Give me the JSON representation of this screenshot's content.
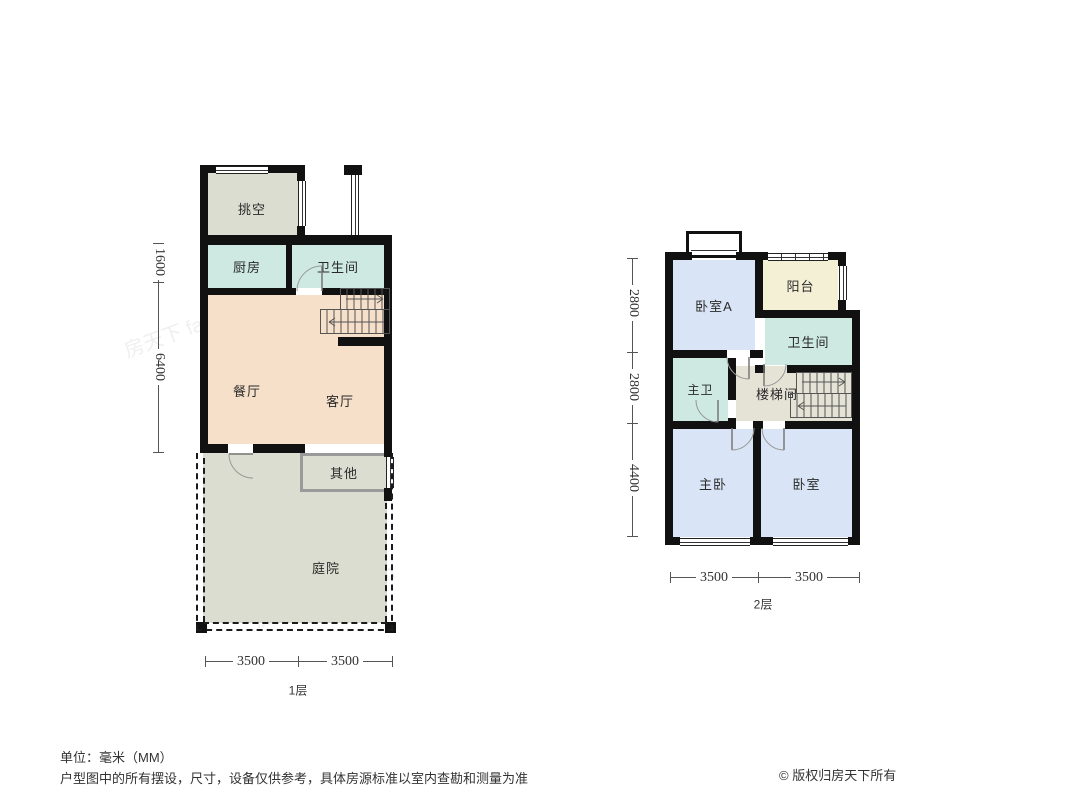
{
  "meta": {
    "unit_note": "单位：毫米（MM）",
    "disclaimer": "户型图中的所有摆设，尺寸，设备仅供参考，具体房源标准以室内查勘和测量为准",
    "copyright": "© 版权归房天下所有",
    "watermark": "房天下 fang.com"
  },
  "colors": {
    "wall": "#111111",
    "living": "#f6e0ca",
    "wet": "#cde9e2",
    "gray": "#dbddd1",
    "bedroom": "#d9e5f6",
    "balcony": "#f4f0d6",
    "stairhall": "#e4e3d6",
    "dimline": "#555555"
  },
  "floor1": {
    "label": "1层",
    "rooms": {
      "void": "挑空",
      "kitchen": "厨房",
      "bath": "卫生间",
      "dining": "餐厅",
      "living": "客厅",
      "other": "其他",
      "yard": "庭院"
    },
    "dims_left": [
      "1600",
      "6400"
    ],
    "dims_bottom": [
      "3500",
      "3500"
    ]
  },
  "floor2": {
    "label": "2层",
    "rooms": {
      "bedroomA": "卧室A",
      "balcony": "阳台",
      "bath": "卫生间",
      "masterBath": "主卫",
      "stairwell": "楼梯间",
      "master": "主卧",
      "bedroom": "卧室"
    },
    "dims_left": [
      "2800",
      "2800",
      "4400"
    ],
    "dims_bottom": [
      "3500",
      "3500"
    ]
  }
}
